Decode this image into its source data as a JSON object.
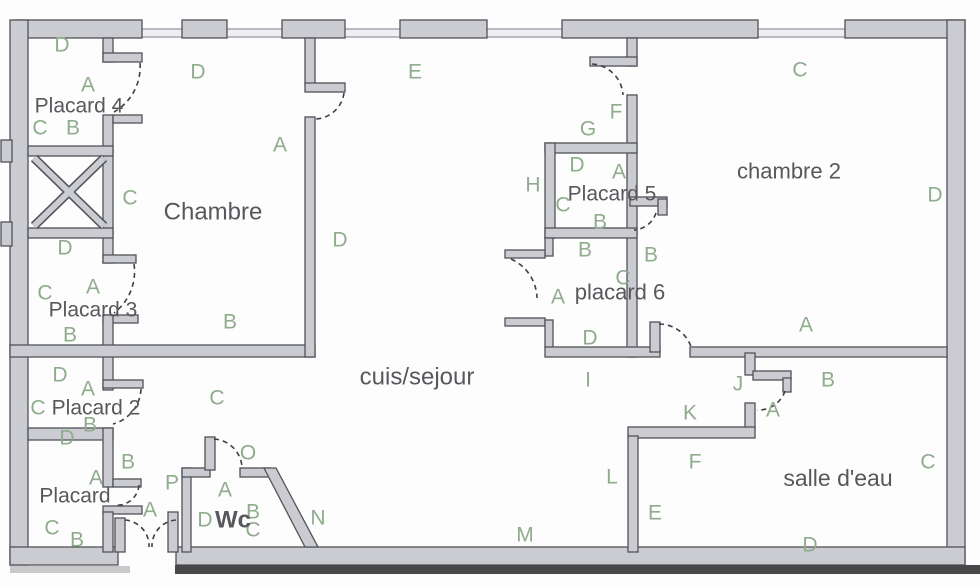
{
  "title": "apartment-floor-plan",
  "colors": {
    "background": "#fdfdfd",
    "wall_fill": "#cbccd1",
    "wall_stroke": "#515257",
    "letter": "#8fac8c",
    "room_text": "#57585c",
    "door": "#3f4044"
  },
  "rooms": [
    {
      "label": "Placard 4",
      "x": 79,
      "y": 106,
      "size": 21
    },
    {
      "label": "Chambre",
      "x": 213,
      "y": 212,
      "size": 24
    },
    {
      "label": "chambre 2",
      "x": 789,
      "y": 171,
      "size": 22
    },
    {
      "label": "Placard 5",
      "x": 612,
      "y": 194,
      "size": 21
    },
    {
      "label": "placard 6",
      "x": 620,
      "y": 292,
      "size": 22
    },
    {
      "label": "Placard 3",
      "x": 93,
      "y": 310,
      "size": 21
    },
    {
      "label": "Placard 2",
      "x": 96,
      "y": 408,
      "size": 21
    },
    {
      "label": "Placard",
      "x": 75,
      "y": 496,
      "size": 21
    },
    {
      "label": "Wc",
      "x": 233,
      "y": 520,
      "size": 24,
      "bold": true
    },
    {
      "label": "cuis/sejour",
      "x": 417,
      "y": 377,
      "size": 24
    },
    {
      "label": "salle d'eau",
      "x": 838,
      "y": 478,
      "size": 23
    }
  ],
  "letters": [
    {
      "t": "D",
      "x": 62,
      "y": 45
    },
    {
      "t": "D",
      "x": 198,
      "y": 72
    },
    {
      "t": "E",
      "x": 415,
      "y": 72
    },
    {
      "t": "C",
      "x": 800,
      "y": 70
    },
    {
      "t": "A",
      "x": 88,
      "y": 85
    },
    {
      "t": "F",
      "x": 616,
      "y": 112
    },
    {
      "t": "C",
      "x": 40,
      "y": 128
    },
    {
      "t": "B",
      "x": 73,
      "y": 128
    },
    {
      "t": "G",
      "x": 588,
      "y": 129
    },
    {
      "t": "A",
      "x": 280,
      "y": 145
    },
    {
      "t": "D",
      "x": 577,
      "y": 165
    },
    {
      "t": "A",
      "x": 619,
      "y": 172
    },
    {
      "t": "H",
      "x": 533,
      "y": 185
    },
    {
      "t": "C",
      "x": 130,
      "y": 198
    },
    {
      "t": "D",
      "x": 935,
      "y": 195
    },
    {
      "t": "C",
      "x": 563,
      "y": 205
    },
    {
      "t": "B",
      "x": 600,
      "y": 222
    },
    {
      "t": "D",
      "x": 340,
      "y": 240
    },
    {
      "t": "D",
      "x": 65,
      "y": 248
    },
    {
      "t": "B",
      "x": 585,
      "y": 250
    },
    {
      "t": "B",
      "x": 651,
      "y": 255
    },
    {
      "t": "C",
      "x": 623,
      "y": 278
    },
    {
      "t": "A",
      "x": 93,
      "y": 287
    },
    {
      "t": "C",
      "x": 45,
      "y": 293
    },
    {
      "t": "A",
      "x": 558,
      "y": 297
    },
    {
      "t": "B",
      "x": 230,
      "y": 322
    },
    {
      "t": "A",
      "x": 806,
      "y": 325
    },
    {
      "t": "B",
      "x": 70,
      "y": 335
    },
    {
      "t": "D",
      "x": 590,
      "y": 338
    },
    {
      "t": "I",
      "x": 588,
      "y": 380
    },
    {
      "t": "J",
      "x": 738,
      "y": 384
    },
    {
      "t": "B",
      "x": 828,
      "y": 380
    },
    {
      "t": "D",
      "x": 60,
      "y": 375
    },
    {
      "t": "A",
      "x": 88,
      "y": 389
    },
    {
      "t": "C",
      "x": 38,
      "y": 408
    },
    {
      "t": "C",
      "x": 217,
      "y": 398
    },
    {
      "t": "B",
      "x": 90,
      "y": 425
    },
    {
      "t": "K",
      "x": 690,
      "y": 413
    },
    {
      "t": "A",
      "x": 773,
      "y": 410
    },
    {
      "t": "D",
      "x": 67,
      "y": 438
    },
    {
      "t": "B",
      "x": 128,
      "y": 462
    },
    {
      "t": "F",
      "x": 695,
      "y": 462
    },
    {
      "t": "C",
      "x": 928,
      "y": 462
    },
    {
      "t": "L",
      "x": 612,
      "y": 477
    },
    {
      "t": "A",
      "x": 96,
      "y": 478
    },
    {
      "t": "P",
      "x": 172,
      "y": 483
    },
    {
      "t": "O",
      "x": 248,
      "y": 453
    },
    {
      "t": "A",
      "x": 225,
      "y": 490
    },
    {
      "t": "A",
      "x": 150,
      "y": 510
    },
    {
      "t": "D",
      "x": 205,
      "y": 520
    },
    {
      "t": "B",
      "x": 253,
      "y": 512
    },
    {
      "t": "C",
      "x": 253,
      "y": 530
    },
    {
      "t": "N",
      "x": 318,
      "y": 518
    },
    {
      "t": "C",
      "x": 52,
      "y": 528
    },
    {
      "t": "B",
      "x": 77,
      "y": 540
    },
    {
      "t": "E",
      "x": 655,
      "y": 513
    },
    {
      "t": "M",
      "x": 525,
      "y": 535
    },
    {
      "t": "D",
      "x": 810,
      "y": 545
    }
  ]
}
